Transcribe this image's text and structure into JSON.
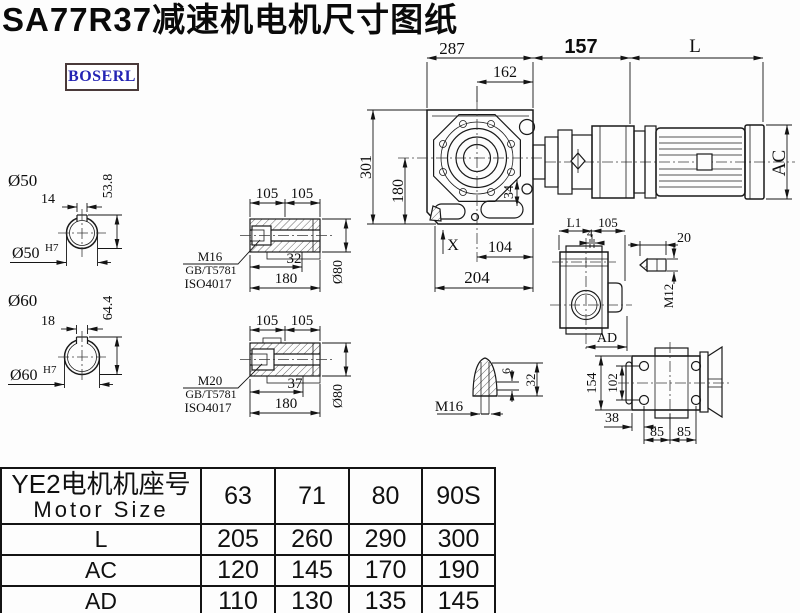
{
  "title": "SA77R37减速机电机尺寸图纸",
  "brand": "BOSERL",
  "drawing": {
    "main": {
      "d287": "287",
      "d162": "162",
      "d157": "157",
      "dL": "L",
      "d301": "301",
      "d180": "180",
      "d34": "34",
      "dX": "X",
      "d104": "104",
      "d204": "204",
      "dAC": "AC"
    },
    "side": {
      "dL1": "L1",
      "d105": "105",
      "d4": "4",
      "dAD": "AD"
    },
    "key": {
      "d20": "20",
      "dM12": "M12"
    },
    "bottom": {
      "d154": "154",
      "d102": "102",
      "d38": "38",
      "d85a": "85",
      "d85b": "85"
    },
    "plug": {
      "dM16": "M16",
      "d6": "6",
      "d32": "32"
    },
    "bore50": {
      "title": "Ø50",
      "d14": "14",
      "d53_8": "53.8",
      "bore": "Ø50",
      "tol": "H7"
    },
    "bore60": {
      "title": "Ø60",
      "d18": "18",
      "d64_4": "64.4",
      "bore": "Ø60",
      "tol": "H7"
    },
    "sleeve1": {
      "d105a": "105",
      "d105b": "105",
      "d32": "32",
      "d180": "180",
      "dia": "Ø80",
      "thread": "M16",
      "std1": "GB/T5781",
      "std2": "ISO4017"
    },
    "sleeve2": {
      "d105a": "105",
      "d105b": "105",
      "d37": "37",
      "d180": "180",
      "dia": "Ø80",
      "thread": "M20",
      "std1": "GB/T5781",
      "std2": "ISO4017"
    }
  },
  "table": {
    "header": {
      "label_cn": "YE2电机机座号",
      "label_en": "Motor Size",
      "columns": [
        "63",
        "71",
        "80",
        "90S"
      ]
    },
    "rows": [
      {
        "label": "L",
        "values": [
          "205",
          "260",
          "290",
          "300"
        ]
      },
      {
        "label": "AC",
        "values": [
          "120",
          "145",
          "170",
          "190"
        ]
      },
      {
        "label": "AD",
        "values": [
          "110",
          "130",
          "135",
          "145"
        ]
      }
    ]
  }
}
